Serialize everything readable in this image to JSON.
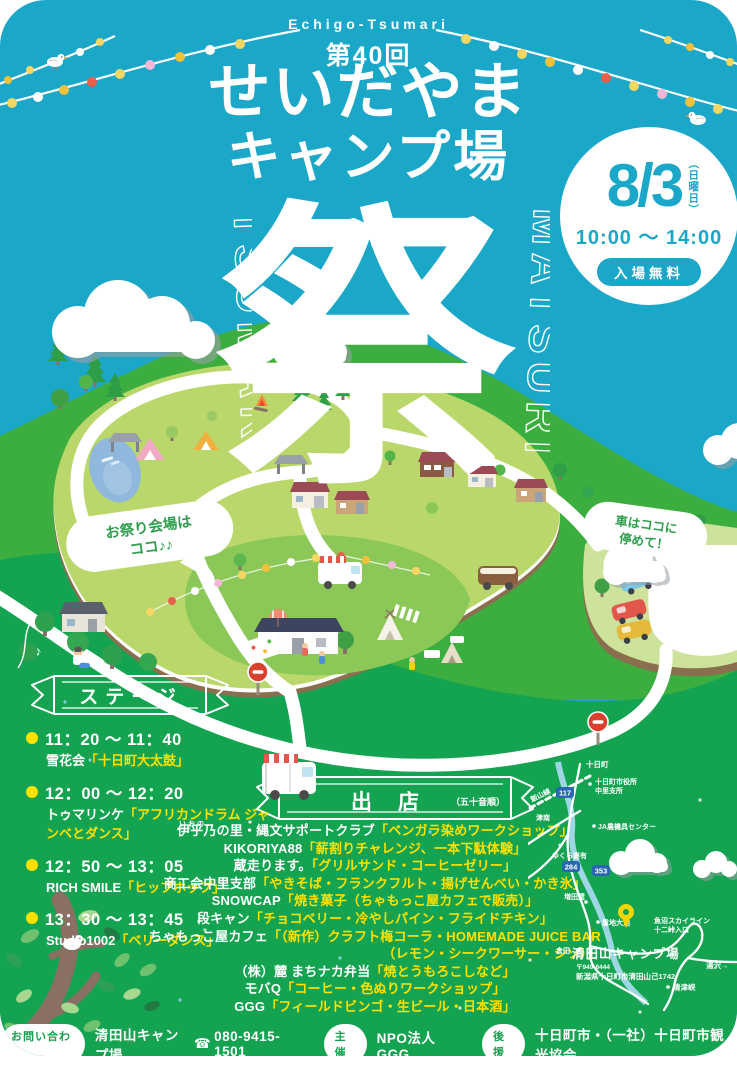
{
  "poster": {
    "brand": "Echigo-Tsumari",
    "edition": "第40回",
    "title_line1": "せいだやま",
    "title_line2": "キャンプ場",
    "festival_kanji": "祭",
    "vertical_left": "TSUMARI",
    "vertical_right": "MATSURI"
  },
  "date_badge": {
    "date": "8/3",
    "weekday": "（日曜日）",
    "time": "10:00 〜 14:00",
    "admission": "入場無料"
  },
  "map_bubbles": {
    "venue_line1": "お祭り会場は",
    "venue_line2": "ココ♪♪",
    "parking_line1": "車はココに",
    "parking_line2": "停めて！"
  },
  "stage": {
    "ribbon_title": "ステージ",
    "items": [
      {
        "time": "11：20 〜 11：40",
        "name": "雪花会",
        "act": "「十日町大太鼓」"
      },
      {
        "time": "12：00 〜 12：20",
        "name": "トゥマリンケ",
        "act": "「アフリカンドラム ジャンベとダンス」"
      },
      {
        "time": "12：50 〜 13：05",
        "name": "RICH SMILE",
        "act": "「ヒップホップ」"
      },
      {
        "time": "13：30 〜 13：45",
        "name": "Studio1002",
        "act": "「ベリーダンス」"
      }
    ]
  },
  "vendors": {
    "ribbon_title": "出店",
    "ribbon_note": "（五十音順）",
    "items": [
      {
        "ruby": "いおの",
        "name": "伊乎乃の里・縄文サポートクラブ",
        "offering": "「ベンガラ染めワークショップ」"
      },
      {
        "name": "KIKORIYA88",
        "offering": "「薪割りチャレンジ、一本下駄体験」"
      },
      {
        "name": "蔵走ります。",
        "offering": "「グリルサンド・コーヒーゼリー」"
      },
      {
        "name": "商工会中里支部",
        "offering": "「やきそば・フランクフルト・揚げせんべい・かき氷」"
      },
      {
        "name": "SNOWCAP",
        "offering": "「焼き菓子（ちゃもっこ屋カフェで販売）」"
      },
      {
        "name": "段キャン",
        "offering": "「チョコベリー・冷やしパイン・フライドチキン」"
      },
      {
        "name": "ちゃもっこ屋カフェ",
        "offering": "「（新作）クラフト梅コーラ・HOMEMADE JUICE BAR",
        "offering2": "（レモン・シークワーサー・シソ）」"
      },
      {
        "name": "（株）麓 まちナカ弁当",
        "offering": "「焼とうもろこしなど」"
      },
      {
        "name": "モバQ",
        "offering": "「コーヒー・色ぬりワークショップ」"
      },
      {
        "name": "GGG",
        "offering": "「フィールドビンゴ・生ビール・日本酒」"
      }
    ]
  },
  "access_map": {
    "labels": {
      "iiyama_line": "飯山線",
      "tokamachi": "十日町",
      "city_office_line1": "十日町市役所",
      "city_office_line2": "中里支所",
      "tsunan": "津南",
      "ja_center": "JA農機具センター",
      "yukura": "ゆくら妻有",
      "masudaya": "増田屋",
      "shigechi_oike": "重地大池",
      "kurata": "倉田",
      "skyline_line1": "魚沼スカイライン",
      "skyline_line2": "十二峠入口",
      "yuzawa": "湯沢→",
      "kiyotsukyo": "清津峡"
    },
    "route_shields": {
      "r117": "117",
      "r284": "284",
      "r353": "353"
    },
    "site_name": "清田山キャンプ場",
    "postal": "〒949-8444",
    "address": "新潟県十日町市清田山己1742"
  },
  "footer": {
    "contact_label": "お問い合わせ",
    "contact_name": "清田山キャンプ場",
    "contact_phone": "080-9415-1501",
    "organizer_label": "主催",
    "organizer_value": "NPO法人GGG",
    "support_label": "後援",
    "support_value": "十日町市・（一社）十日町市観光協会"
  },
  "icons": {
    "phone_glyph": "☎"
  },
  "colors": {
    "sky": "#1ba7c8",
    "land_green": "#14a351",
    "hill_green": "#3cae3f",
    "plateau_green": "#b9d76a",
    "festival_green": "#8cc858",
    "accent_yellow": "#ffe100",
    "teal": "#1ba7c8",
    "no_entry_red": "#d9402f",
    "pin_yellow": "#f2d500"
  }
}
